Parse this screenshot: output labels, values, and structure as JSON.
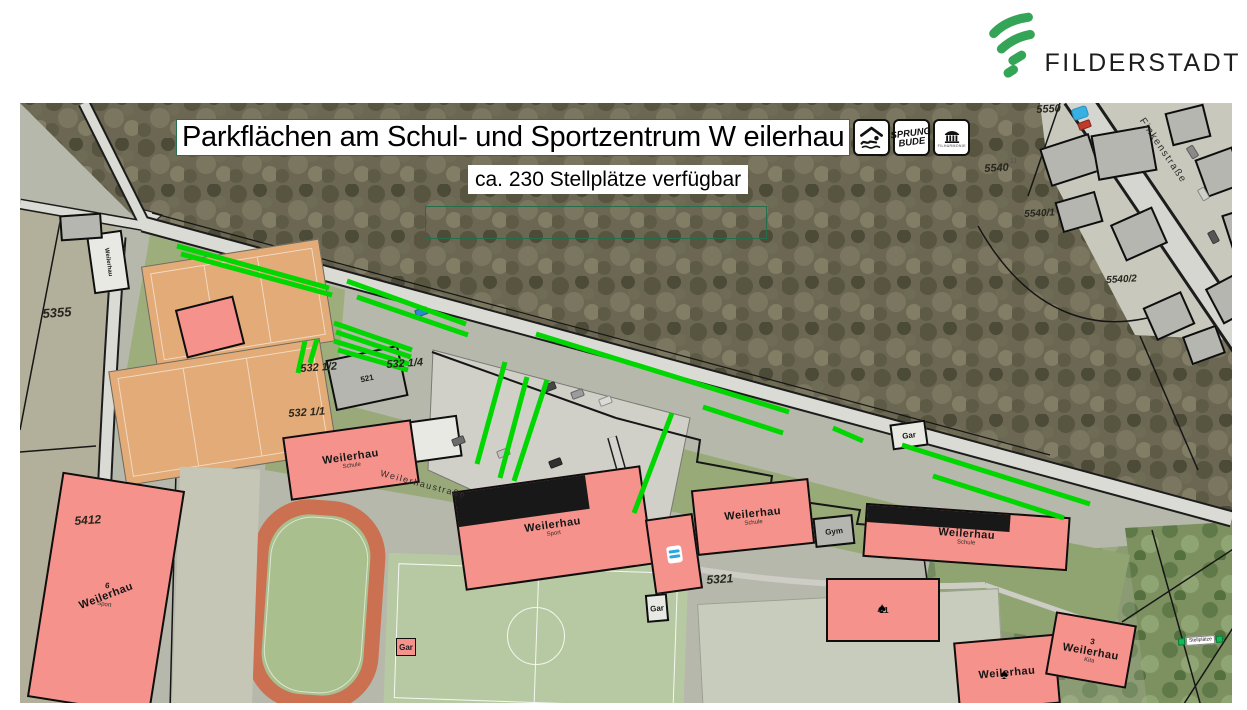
{
  "logo": {
    "text": "FILDERSTADT"
  },
  "title": {
    "text": "Parkflächen am Schul- und Sportzentrum W eilerhau"
  },
  "subtitle": {
    "text": "ca. 230 Stellplätze verfügbar"
  },
  "badges": {
    "swimming": {
      "icon": "swimmer-icon"
    },
    "sprungbude": {
      "line1": "SPRUNG",
      "line2": "BUDE"
    },
    "filharmonie": {
      "icon": "columns-icon",
      "caption": "FILHARMONIE"
    }
  },
  "colors": {
    "stripe_green": "#00d600",
    "building_pink": "#f5928b",
    "court_orange": "#e2ab77",
    "brand_green": "#34a457"
  },
  "map": {
    "scale_marker": {
      "text": "Stellplätze"
    },
    "green_stripes": [
      [
        177,
        246,
        329,
        288
      ],
      [
        181,
        254,
        332,
        295
      ],
      [
        347,
        281,
        466,
        324
      ],
      [
        357,
        297,
        468,
        335
      ],
      [
        334,
        323,
        412,
        350
      ],
      [
        336,
        332,
        411,
        357
      ],
      [
        334,
        341,
        409,
        364
      ],
      [
        338,
        350,
        408,
        370
      ],
      [
        305,
        341,
        298,
        373
      ],
      [
        317,
        339,
        310,
        363
      ],
      [
        536,
        334,
        789,
        412
      ],
      [
        703,
        407,
        783,
        433
      ],
      [
        505,
        362,
        477,
        464
      ],
      [
        527,
        377,
        500,
        478
      ],
      [
        547,
        380,
        514,
        481
      ],
      [
        672,
        413,
        634,
        513
      ],
      [
        833,
        428,
        863,
        441
      ],
      [
        902,
        445,
        1090,
        504
      ],
      [
        933,
        476,
        1064,
        518
      ]
    ],
    "parcel_labels": [
      {
        "t": "5355",
        "x": 42,
        "y": 306,
        "r": -4,
        "s": 13,
        "c": "parcel"
      },
      {
        "t": "5412",
        "x": 74,
        "y": 514,
        "r": -4,
        "s": 12,
        "c": "parcel"
      },
      {
        "t": "532 1/2",
        "x": 300,
        "y": 363,
        "r": -4,
        "s": 11,
        "c": "parcel"
      },
      {
        "t": "532 1/4",
        "x": 386,
        "y": 359,
        "r": -4,
        "s": 11,
        "c": "parcel"
      },
      {
        "t": "532 1/1",
        "x": 288,
        "y": 408,
        "r": -4,
        "s": 11,
        "c": "parcel"
      },
      {
        "t": "5321",
        "x": 706,
        "y": 573,
        "r": -4,
        "s": 12,
        "c": "parcel"
      },
      {
        "t": "5550",
        "x": 1036,
        "y": 104,
        "r": -3,
        "s": 11,
        "c": "parcel"
      },
      {
        "t": "5540",
        "x": 984,
        "y": 163,
        "r": -3,
        "s": 11,
        "c": "parcel"
      },
      {
        "t": "5540/1",
        "x": 1024,
        "y": 209,
        "r": -3,
        "s": 10,
        "c": "parcel"
      },
      {
        "t": "5540/2",
        "x": 1106,
        "y": 275,
        "r": -3,
        "s": 10,
        "c": "parcel"
      },
      {
        "t": "11",
        "x": 1010,
        "y": 158,
        "r": 0,
        "s": 7,
        "c": "hnum"
      },
      {
        "t": "♠",
        "x": 878,
        "y": 600,
        "r": 0,
        "s": 15,
        "c": "sym"
      },
      {
        "t": "♠",
        "x": 1000,
        "y": 666,
        "r": 0,
        "s": 15,
        "c": "sym"
      }
    ],
    "street_labels": [
      {
        "t": "Finkenstraße",
        "x": 1146,
        "y": 116,
        "r": 56,
        "s": 10,
        "c": "street"
      },
      {
        "t": "Weilerhaustraße",
        "x": 382,
        "y": 468,
        "r": 15,
        "s": 9,
        "c": "street"
      }
    ],
    "buildings": [
      {
        "x": 90,
        "y": 232,
        "w": 36,
        "h": 60,
        "r": -8,
        "k": "light",
        "vlabel": "Weilerhau"
      },
      {
        "x": 60,
        "y": 214,
        "w": 42,
        "h": 26,
        "r": -4,
        "k": "gray"
      },
      {
        "x": 180,
        "y": 302,
        "w": 60,
        "h": 50,
        "r": -14,
        "k": "pink"
      },
      {
        "x": 330,
        "y": 352,
        "w": 74,
        "h": 52,
        "r": -12,
        "k": "gray",
        "num": "521"
      },
      {
        "x": 410,
        "y": 418,
        "w": 50,
        "h": 42,
        "r": -8,
        "k": "light"
      },
      {
        "x": 286,
        "y": 428,
        "w": 130,
        "h": 64,
        "r": -8,
        "k": "pink",
        "label": "Weilerhau",
        "sub": "Schule"
      },
      {
        "x": 458,
        "y": 478,
        "w": 190,
        "h": 100,
        "r": -8,
        "k": "pink",
        "band": true,
        "label": "Weilerhau",
        "sub": "Sport"
      },
      {
        "x": 650,
        "y": 516,
        "w": 48,
        "h": 76,
        "r": -8,
        "k": "pink",
        "pool": true
      },
      {
        "x": 694,
        "y": 484,
        "w": 118,
        "h": 66,
        "r": -6,
        "k": "pink",
        "label": "Weilerhau",
        "sub": "Schule"
      },
      {
        "x": 814,
        "y": 516,
        "w": 40,
        "h": 30,
        "r": -6,
        "k": "gray",
        "num": "Gym"
      },
      {
        "x": 864,
        "y": 510,
        "w": 205,
        "h": 54,
        "r": 4,
        "k": "pink",
        "band": true,
        "label": "Weilerhau",
        "sub": "Schule"
      },
      {
        "x": 826,
        "y": 578,
        "w": 114,
        "h": 64,
        "r": 0,
        "k": "pink",
        "num": "4/1"
      },
      {
        "x": 956,
        "y": 638,
        "w": 102,
        "h": 70,
        "r": -5,
        "k": "pink",
        "label": "Weilerhau"
      },
      {
        "x": 1050,
        "y": 618,
        "w": 82,
        "h": 64,
        "r": 10,
        "k": "pink",
        "label": "Weilerhau",
        "sub": "Kita",
        "num": "3"
      },
      {
        "x": 44,
        "y": 480,
        "w": 124,
        "h": 228,
        "r": 9,
        "k": "pink",
        "label": "Weilerhau",
        "sub": "Sport",
        "num": "6",
        "lr": -30
      },
      {
        "x": 396,
        "y": 638,
        "w": 20,
        "h": 18,
        "r": 0,
        "k": "pinksm",
        "num": "Gar"
      },
      {
        "x": 646,
        "y": 594,
        "w": 22,
        "h": 28,
        "r": -5,
        "k": "light",
        "num": "Gar"
      },
      {
        "x": 891,
        "y": 422,
        "w": 36,
        "h": 26,
        "r": -8,
        "k": "light",
        "num": "Gar"
      },
      {
        "x": 1044,
        "y": 140,
        "w": 52,
        "h": 40,
        "r": -18,
        "k": "gray"
      },
      {
        "x": 1094,
        "y": 130,
        "w": 60,
        "h": 46,
        "r": -10,
        "k": "gray"
      },
      {
        "x": 1058,
        "y": 196,
        "w": 42,
        "h": 32,
        "r": -16,
        "k": "gray"
      },
      {
        "x": 1116,
        "y": 214,
        "w": 46,
        "h": 40,
        "r": -24,
        "k": "gray"
      },
      {
        "x": 1168,
        "y": 108,
        "w": 40,
        "h": 34,
        "r": -14,
        "k": "gray"
      },
      {
        "x": 1200,
        "y": 152,
        "w": 40,
        "h": 40,
        "r": -20,
        "k": "gray"
      },
      {
        "x": 1212,
        "y": 278,
        "w": 38,
        "h": 40,
        "r": -28,
        "k": "gray"
      },
      {
        "x": 1148,
        "y": 298,
        "w": 42,
        "h": 36,
        "r": -24,
        "k": "gray"
      },
      {
        "x": 1186,
        "y": 330,
        "w": 36,
        "h": 30,
        "r": -20,
        "k": "gray"
      },
      {
        "x": 1226,
        "y": 210,
        "w": 30,
        "h": 36,
        "r": -18,
        "k": "gray"
      }
    ],
    "cars": [
      [
        543,
        383,
        -21,
        "#474747"
      ],
      [
        571,
        390,
        -21,
        "#9b9b9b"
      ],
      [
        599,
        397,
        -21,
        "#dadad6"
      ],
      [
        452,
        437,
        -21,
        "#6b6b6b"
      ],
      [
        497,
        449,
        -21,
        "#c2c2bd"
      ],
      [
        549,
        459,
        -21,
        "#303030"
      ],
      [
        415,
        308,
        -21,
        "#2f86d6"
      ],
      [
        1186,
        148,
        58,
        "#8a8a8a"
      ],
      [
        1197,
        190,
        60,
        "#d0d0cb"
      ],
      [
        1207,
        233,
        62,
        "#565656"
      ],
      [
        1078,
        121,
        -20,
        "#c0392b"
      ]
    ]
  }
}
